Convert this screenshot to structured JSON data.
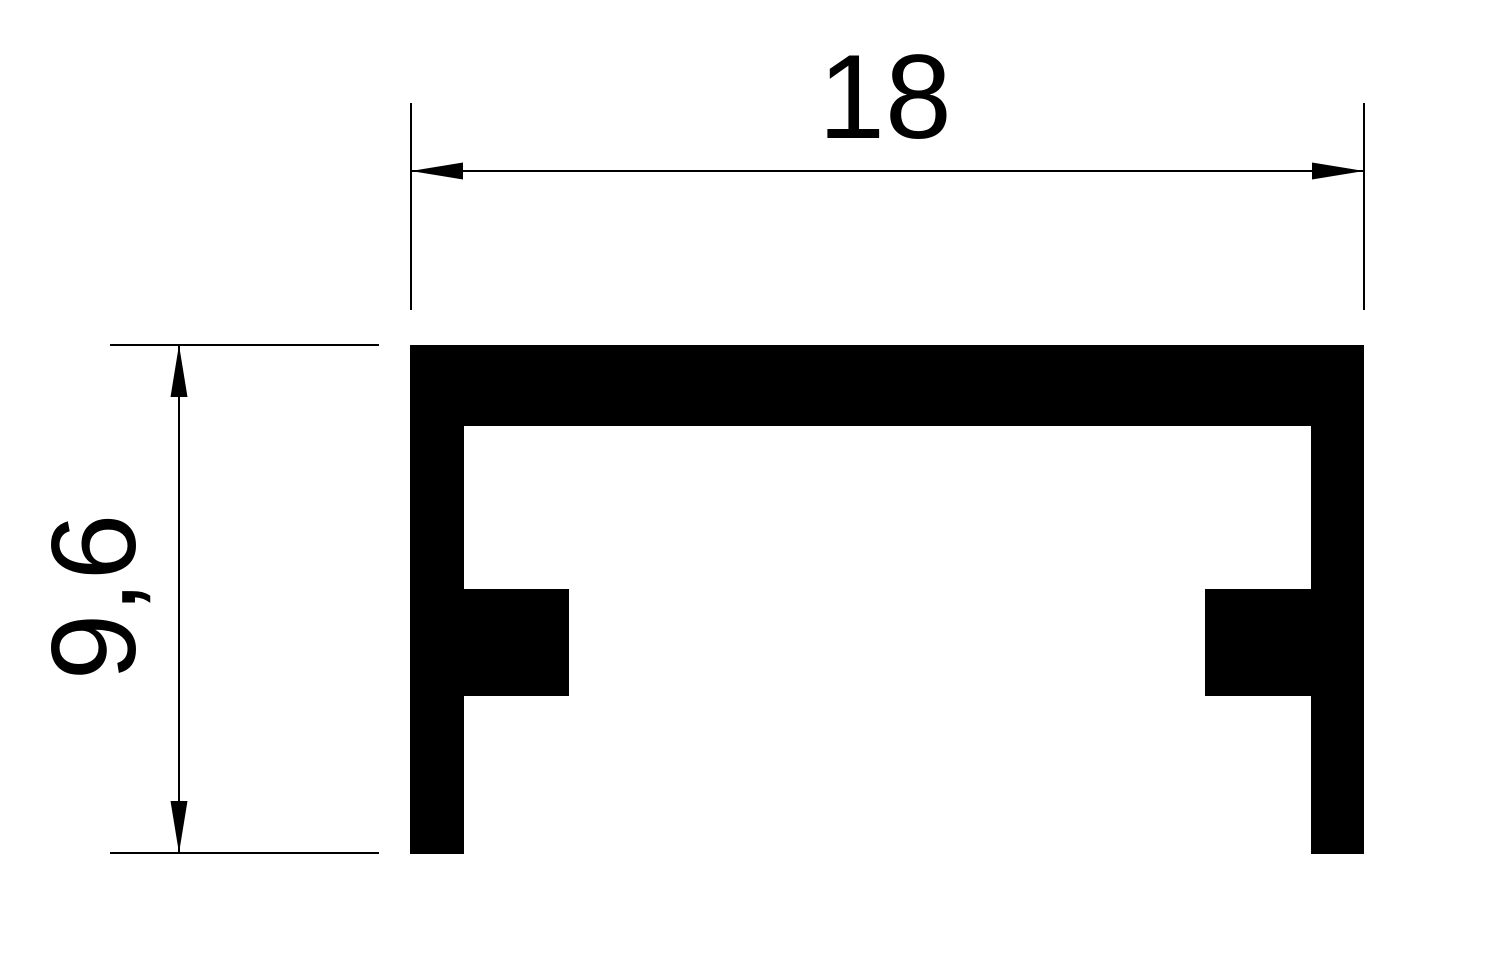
{
  "drawing": {
    "type": "profile-cross-section-technical-drawing",
    "shape": "u-channel-with-inner-tabs",
    "colors": {
      "ink": "#000000",
      "background": "#ffffff"
    },
    "dimensions": {
      "width": {
        "label": "18",
        "value": 18,
        "orientation": "horizontal",
        "position": "top"
      },
      "height": {
        "label": "9,6",
        "value": 9.6,
        "orientation": "vertical",
        "position": "left"
      }
    }
  }
}
